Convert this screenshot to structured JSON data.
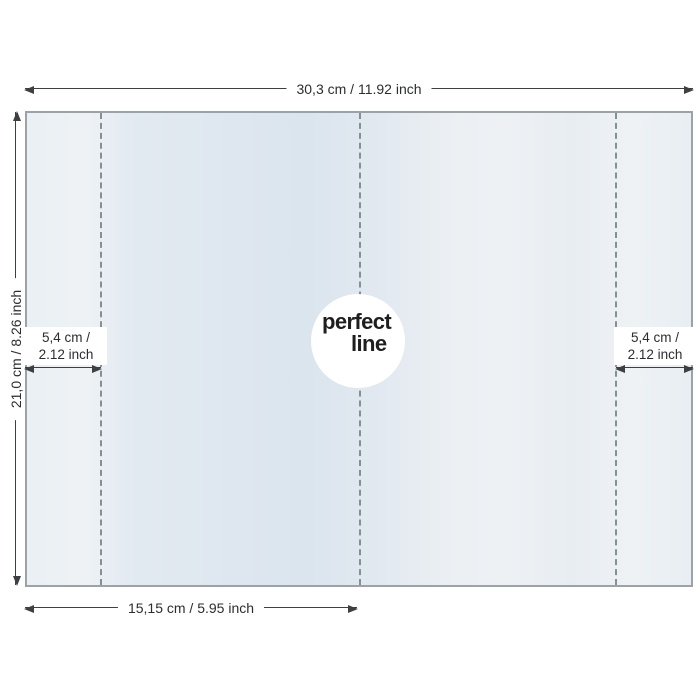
{
  "labels": {
    "total_width": "30,3 cm / 11.92 inch",
    "total_height": "21,0 cm / 8.26 inch",
    "flap_left": {
      "line1": "5,4 cm /",
      "line2": "2.12 inch"
    },
    "flap_right": {
      "line1": "5,4 cm /",
      "line2": "2.12 inch"
    },
    "half_width": "15,15 cm / 5.95 inch"
  },
  "logo": {
    "word1": "perfect",
    "word2": "line"
  },
  "colors": {
    "dimension_line": "#3d4043",
    "label_text": "#2b2d2f",
    "fold_dash": "#878f96",
    "cover_border": "#9ba3a9",
    "cover_tint_blue": "#dbe5ee",
    "cover_tint_light": "#eef2f5",
    "logo_circle": "#ffffff",
    "logo_text": "#1e1e1e",
    "page_background": "#ffffff"
  }
}
